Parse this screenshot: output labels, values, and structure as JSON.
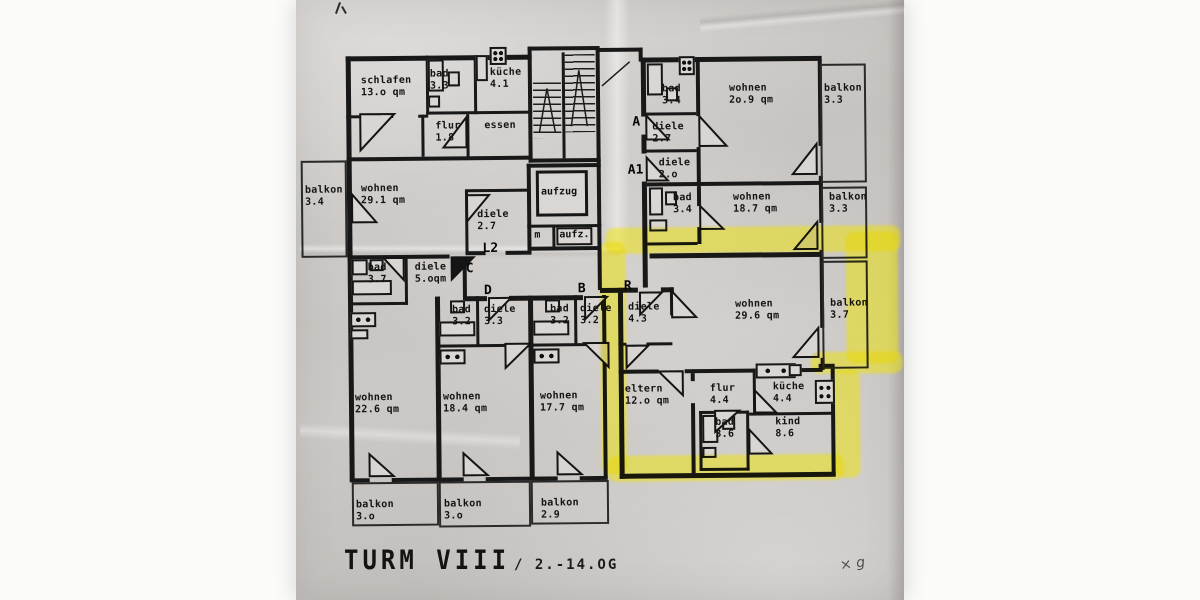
{
  "title": {
    "building": "TURM VIII",
    "floors": "/ 2.-14.OG"
  },
  "core": {
    "aufzug": "aufzug",
    "aufz": "aufz.",
    "m": "m"
  },
  "door_labels": {
    "a": "A",
    "a1": "A1",
    "l2": "L2",
    "c": "C",
    "d": "D",
    "b": "B",
    "r": "R"
  },
  "rooms": [
    {
      "label": "schlafen",
      "area": "13.o qm"
    },
    {
      "label": "bad",
      "area": "3.3"
    },
    {
      "label": "küche",
      "area": "4.1"
    },
    {
      "label": "flur",
      "area": "1.8"
    },
    {
      "label": "essen",
      "area": ""
    },
    {
      "label": "bad",
      "area": "3.4"
    },
    {
      "label": "wohnen",
      "area": "2o.9 qm"
    },
    {
      "label": "balkon",
      "area": "3.3"
    },
    {
      "label": "diele",
      "area": "2.7"
    },
    {
      "label": "diele",
      "area": "2.o"
    },
    {
      "label": "bad",
      "area": "3.4"
    },
    {
      "label": "wohnen",
      "area": "18.7 qm"
    },
    {
      "label": "balkon",
      "area": "3.3"
    },
    {
      "label": "balkon",
      "area": "3.4"
    },
    {
      "label": "wohnen",
      "area": "29.1 qm"
    },
    {
      "label": "diele",
      "area": "2.7"
    },
    {
      "label": "bad",
      "area": "3.7"
    },
    {
      "label": "diele",
      "area": "5.oqm"
    },
    {
      "label": "bad",
      "area": "3.2"
    },
    {
      "label": "diele",
      "area": "3.3"
    },
    {
      "label": "bad",
      "area": "3.2"
    },
    {
      "label": "diele",
      "area": "3.2"
    },
    {
      "label": "diele",
      "area": "4.3"
    },
    {
      "label": "wohnen",
      "area": "29.6 qm"
    },
    {
      "label": "balkon",
      "area": "3.7"
    },
    {
      "label": "wohnen",
      "area": "22.6 qm"
    },
    {
      "label": "wohnen",
      "area": "18.4 qm"
    },
    {
      "label": "wohnen",
      "area": "17.7 qm"
    },
    {
      "label": "eltern",
      "area": "12.o qm"
    },
    {
      "label": "flur",
      "area": "4.4"
    },
    {
      "label": "küche",
      "area": "4.4"
    },
    {
      "label": "bad",
      "area": "3.6"
    },
    {
      "label": "kind",
      "area": "8.6"
    },
    {
      "label": "balkon",
      "area": "3.o"
    },
    {
      "label": "balkon",
      "area": "3.o"
    },
    {
      "label": "balkon",
      "area": "2.9"
    }
  ],
  "annotations": {
    "signature": "× g"
  },
  "colors": {
    "highlight": "#f0e400",
    "ink": "#181818",
    "paper": "#c9c6c3"
  }
}
